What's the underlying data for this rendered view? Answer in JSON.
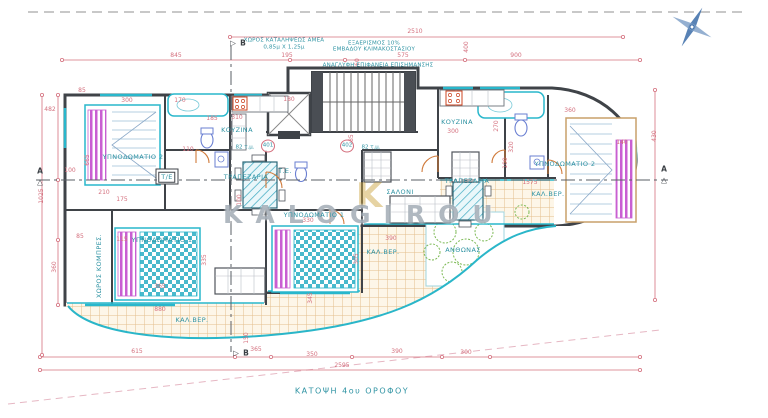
{
  "title": {
    "text": "ΚΑΤΟΨΗ 4ου ΟΡΟΦΟΥ"
  },
  "watermark": {
    "text": "KALOGIROU",
    "logo": "K"
  },
  "colors": {
    "dimension": "#d4707e",
    "label": "#2f93a3",
    "wall": "#3f4348",
    "fixture": "#29b7cc",
    "site_boundary": "#2ab6c9",
    "tile": "#dcaa6e",
    "bed_stripe": "#c95fd2",
    "north": "#3b6ca8"
  },
  "units": [
    {
      "num": "401",
      "area": "82 τ.μ.",
      "cx": 268,
      "cy": 146,
      "tx": 245,
      "ty": 148
    },
    {
      "num": "402",
      "area": "82 τ.μ.",
      "cx": 347,
      "cy": 146,
      "tx": 371,
      "ty": 148
    }
  ],
  "rooms": [
    {
      "t": "ΥΠΝΟΔΩΜΑΤΙΟ 2",
      "x": 133,
      "y": 157
    },
    {
      "t": "ΥΠΝΟΔΩΜΑΤΙΟ 1",
      "x": 162,
      "y": 240
    },
    {
      "t": "ΚΟΥΖΙΝΑ",
      "x": 237,
      "y": 130
    },
    {
      "t": "ΤΡΑΠΕΖΑΡΙΑ",
      "x": 246,
      "y": 177
    },
    {
      "t": "Τ/Ε",
      "x": 167,
      "y": 177,
      "box": 1
    },
    {
      "t": "Τ.Ε.",
      "x": 285,
      "y": 171
    },
    {
      "t": "ΥΠΝΟΔΩΜΑΤΙΟ 1",
      "x": 314,
      "y": 215
    },
    {
      "t": "ΣΑΛΟΝΙ",
      "x": 400,
      "y": 192
    },
    {
      "t": "ΚΟΥΖΙΝΑ",
      "x": 457,
      "y": 122
    },
    {
      "t": "ΤΡΑΠΕΖΑΡΙΑ",
      "x": 467,
      "y": 181
    },
    {
      "t": "ΥΠΝΟΔΩΜΑΤΙΟ 2",
      "x": 565,
      "y": 164
    },
    {
      "t": "ΚΑΛ.ΒΕΡ.",
      "x": 192,
      "y": 320
    },
    {
      "t": "ΚΑΛ.ΒΕΡ.",
      "x": 383,
      "y": 252
    },
    {
      "t": "ΚΑΛ.ΒΕΡ.",
      "x": 548,
      "y": 194
    },
    {
      "t": "ΑΝΘΩΝΑΣ",
      "x": 463,
      "y": 250
    },
    {
      "t": "ΧΩΡΟΣ ΚΟΜΠΡΕΣ.",
      "x": 99,
      "y": 266,
      "v": 1
    }
  ],
  "annotations": [
    {
      "t": "ΧΩΡΟΣ ΚΑΤΑΛΗΨΕΩΣ ΑΜΕΑ",
      "x": 284,
      "y": 41
    },
    {
      "t": "0,85μ Χ 1,25μ",
      "x": 284,
      "y": 48
    },
    {
      "t": "ΕΞΑΕΡΙΣΜΟΣ 10%",
      "x": 374,
      "y": 44
    },
    {
      "t": "ΕΜΒΑΔΟΥ ΚΛΙΜΑΚΟΣΤΑΣΙΟΥ",
      "x": 374,
      "y": 50
    },
    {
      "t": "ΑΝΑΓΛΥΦΗ ΕΠΙΦΑΝΕΙΑ ΕΠΙΣΗΜΑΝΣΗΣ",
      "x": 378,
      "y": 66
    }
  ],
  "markers": [
    {
      "t": "▷",
      "x": 233,
      "y": 43
    },
    {
      "t": "B",
      "x": 243,
      "y": 43
    },
    {
      "t": "▷",
      "x": 236,
      "y": 353
    },
    {
      "t": "B",
      "x": 246,
      "y": 353
    },
    {
      "t": "A",
      "x": 40,
      "y": 171
    },
    {
      "t": "△",
      "x": 40,
      "y": 182
    },
    {
      "t": "A",
      "x": 664,
      "y": 169
    },
    {
      "t": "△",
      "x": 664,
      "y": 180
    }
  ],
  "dims": [
    {
      "t": "2510",
      "x": 415,
      "y": 32
    },
    {
      "t": "845",
      "x": 176,
      "y": 56
    },
    {
      "t": "195",
      "x": 287,
      "y": 56
    },
    {
      "t": "575",
      "x": 403,
      "y": 56
    },
    {
      "t": "900",
      "x": 516,
      "y": 56
    },
    {
      "t": "400",
      "x": 467,
      "y": 47,
      "v": 1
    },
    {
      "t": "60",
      "x": 358,
      "y": 62,
      "v": 1
    },
    {
      "t": "85",
      "x": 82,
      "y": 91
    },
    {
      "t": "482",
      "x": 50,
      "y": 110
    },
    {
      "t": "665",
      "x": 88,
      "y": 160,
      "v": 1
    },
    {
      "t": "1025",
      "x": 42,
      "y": 196,
      "v": 1
    },
    {
      "t": "100",
      "x": 70,
      "y": 171
    },
    {
      "t": "85",
      "x": 80,
      "y": 237
    },
    {
      "t": "360",
      "x": 55,
      "y": 267,
      "v": 1
    },
    {
      "t": "300",
      "x": 127,
      "y": 101
    },
    {
      "t": "170",
      "x": 180,
      "y": 101
    },
    {
      "t": "185",
      "x": 212,
      "y": 119
    },
    {
      "t": "110",
      "x": 188,
      "y": 150
    },
    {
      "t": "210",
      "x": 104,
      "y": 193
    },
    {
      "t": "175",
      "x": 122,
      "y": 200
    },
    {
      "t": "115",
      "x": 122,
      "y": 240
    },
    {
      "t": "335",
      "x": 205,
      "y": 260,
      "v": 1
    },
    {
      "t": "365",
      "x": 160,
      "y": 287
    },
    {
      "t": "310",
      "x": 237,
      "y": 118
    },
    {
      "t": "180",
      "x": 289,
      "y": 100
    },
    {
      "t": "330",
      "x": 308,
      "y": 221
    },
    {
      "t": "390",
      "x": 391,
      "y": 239
    },
    {
      "t": "305",
      "x": 357,
      "y": 259,
      "v": 1
    },
    {
      "t": "345",
      "x": 311,
      "y": 298,
      "v": 1
    },
    {
      "t": "150",
      "x": 247,
      "y": 338,
      "v": 1
    },
    {
      "t": "880",
      "x": 160,
      "y": 310
    },
    {
      "t": "615",
      "x": 137,
      "y": 352
    },
    {
      "t": "365",
      "x": 256,
      "y": 350
    },
    {
      "t": "350",
      "x": 312,
      "y": 355
    },
    {
      "t": "390",
      "x": 397,
      "y": 352
    },
    {
      "t": "300",
      "x": 466,
      "y": 353
    },
    {
      "t": "2595",
      "x": 342,
      "y": 366
    },
    {
      "t": "300",
      "x": 453,
      "y": 132
    },
    {
      "t": "360",
      "x": 570,
      "y": 111
    },
    {
      "t": "320",
      "x": 512,
      "y": 147,
      "v": 1
    },
    {
      "t": "270",
      "x": 497,
      "y": 126,
      "v": 1
    },
    {
      "t": "100",
      "x": 506,
      "y": 163,
      "v": 1
    },
    {
      "t": "1575",
      "x": 530,
      "y": 183
    },
    {
      "t": "140",
      "x": 622,
      "y": 143
    },
    {
      "t": "430",
      "x": 655,
      "y": 136,
      "v": 1
    },
    {
      "t": "100",
      "x": 240,
      "y": 200,
      "v": 1
    },
    {
      "t": "185",
      "x": 352,
      "y": 140,
      "v": 1
    }
  ]
}
